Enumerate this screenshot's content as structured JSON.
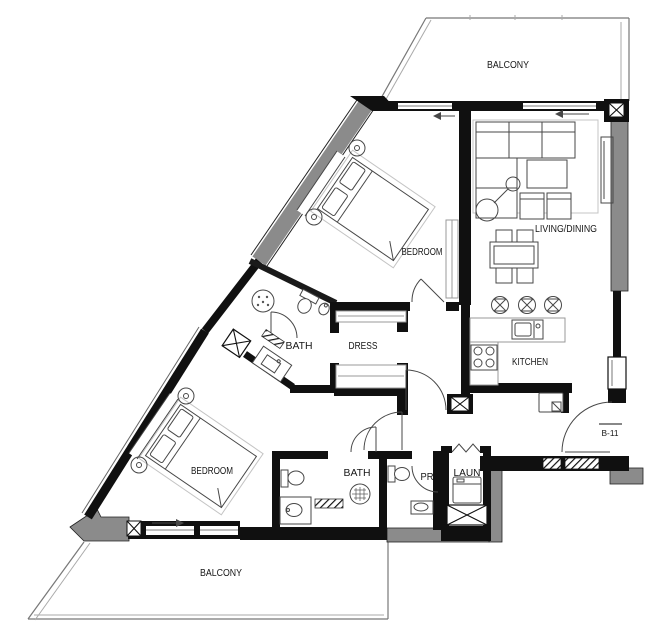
{
  "colors": {
    "wall": "#101010",
    "wall_gray": "#8b8b8b",
    "line": "#474747"
  },
  "rooms": {
    "balcony_top": {
      "label": "BALCONY"
    },
    "living_dining": {
      "label": "LIVING/DINING"
    },
    "bedroom_1": {
      "label": "BEDROOM"
    },
    "kitchen": {
      "label": "KITCHEN"
    },
    "bath_1": {
      "label": "BATH"
    },
    "dress": {
      "label": "DRESS"
    },
    "bedroom_2": {
      "label": "BEDROOM"
    },
    "bath_2": {
      "label": "BATH"
    },
    "powder_room": {
      "label": "PR"
    },
    "laundry": {
      "label": "LAUN"
    },
    "balcony_bottom": {
      "label": "BALCONY"
    }
  },
  "entry": {
    "door_tag": "B-11"
  }
}
